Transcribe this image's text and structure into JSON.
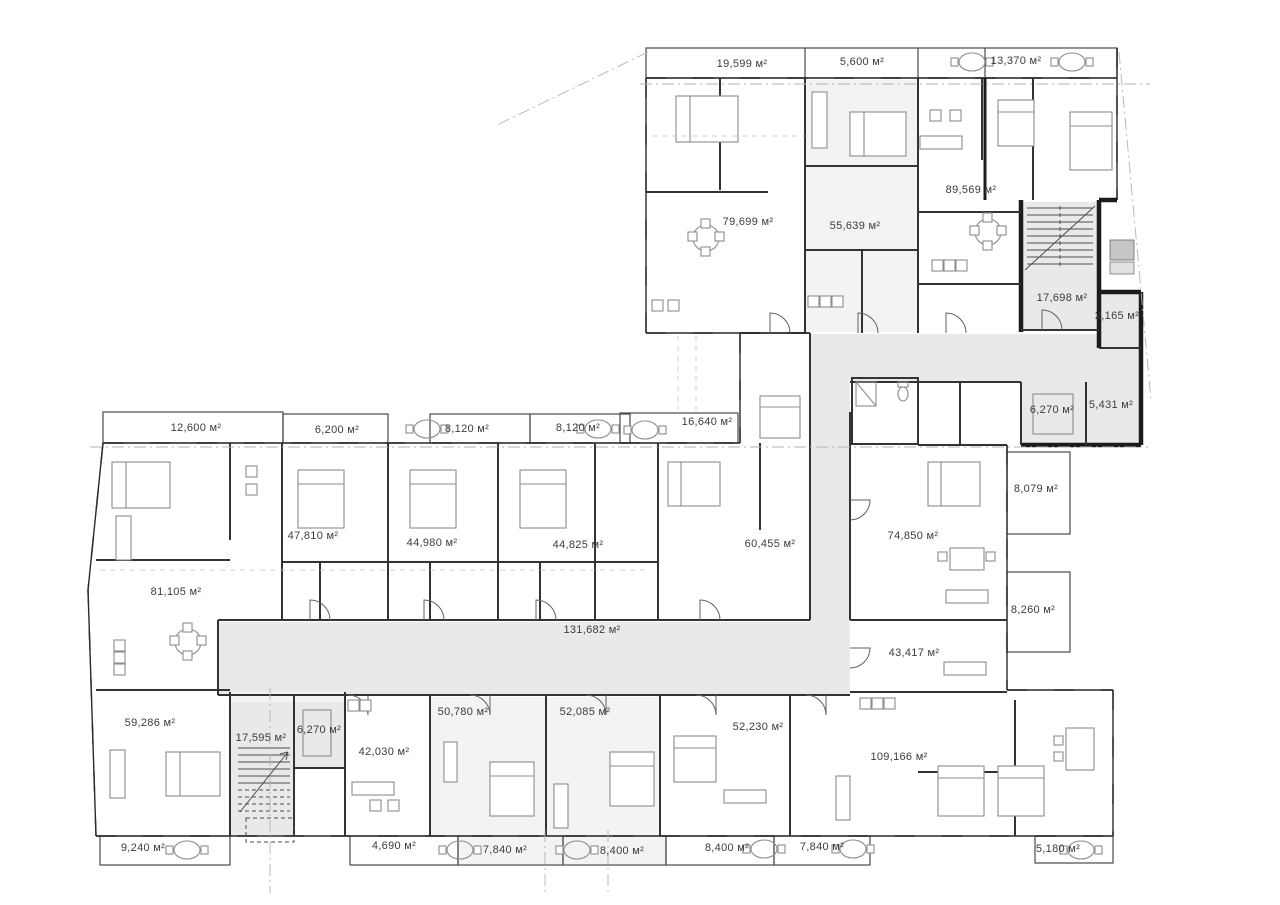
{
  "plan": {
    "drawing_type": "residential-floor-plan",
    "area_unit": "м²",
    "area_labels": [
      {
        "name": "terrace-unit-79699",
        "text": "19,599 м²"
      },
      {
        "name": "terrace-unit-55639",
        "text": "5,600 м²"
      },
      {
        "name": "terrace-13370",
        "text": "13,370 м²"
      },
      {
        "name": "unit-79699",
        "text": "79,699 м²"
      },
      {
        "name": "unit-55639",
        "text": "55,639 м²"
      },
      {
        "name": "unit-89569",
        "text": "89,569 м²"
      },
      {
        "name": "stairwell-17698",
        "text": "17,698 м²"
      },
      {
        "name": "room-2165",
        "text": "2,165 м²"
      },
      {
        "name": "elevator-6270-upper",
        "text": "6,270 м²"
      },
      {
        "name": "room-5431",
        "text": "5,431 м²"
      },
      {
        "name": "balcony-8079",
        "text": "8,079 м²"
      },
      {
        "name": "unit-74850",
        "text": "74,850 м²"
      },
      {
        "name": "balcony-8260",
        "text": "8,260 м²"
      },
      {
        "name": "unit-43417",
        "text": "43,417 м²"
      },
      {
        "name": "terrace-16640",
        "text": "16,640 м²"
      },
      {
        "name": "unit-60455",
        "text": "60,455 м²"
      },
      {
        "name": "terrace-12600",
        "text": "12,600 м²"
      },
      {
        "name": "terrace-6200",
        "text": "6,200 м²"
      },
      {
        "name": "terrace-8120-a",
        "text": "8,120 м²"
      },
      {
        "name": "terrace-8120-b",
        "text": "8,120 м²"
      },
      {
        "name": "unit-47810",
        "text": "47,810 м²"
      },
      {
        "name": "unit-44980",
        "text": "44,980 м²"
      },
      {
        "name": "unit-44825",
        "text": "44,825 м²"
      },
      {
        "name": "unit-81105",
        "text": "81,105 м²"
      },
      {
        "name": "corridor-131682",
        "text": "131,682 м²"
      },
      {
        "name": "unit-59286",
        "text": "59,286 м²"
      },
      {
        "name": "stairwell-17595",
        "text": "17,595 м²"
      },
      {
        "name": "elevator-6270-lower",
        "text": "6,270 м²"
      },
      {
        "name": "unit-42030",
        "text": "42,030 м²"
      },
      {
        "name": "unit-50780",
        "text": "50,780 м²"
      },
      {
        "name": "unit-52085",
        "text": "52,085 м²"
      },
      {
        "name": "unit-52230",
        "text": "52,230 м²"
      },
      {
        "name": "unit-109166",
        "text": "109,166 м²"
      },
      {
        "name": "balcony-9240",
        "text": "9,240 м²"
      },
      {
        "name": "balcony-4690",
        "text": "4,690 м²"
      },
      {
        "name": "balcony-7840-a",
        "text": "7,840 м²"
      },
      {
        "name": "balcony-8400-a",
        "text": "8,400 м²"
      },
      {
        "name": "balcony-8400-b",
        "text": "8,400 м²"
      },
      {
        "name": "balcony-7840-b",
        "text": "7,840 м²"
      },
      {
        "name": "balcony-5180",
        "text": "5,180 м²"
      }
    ]
  }
}
